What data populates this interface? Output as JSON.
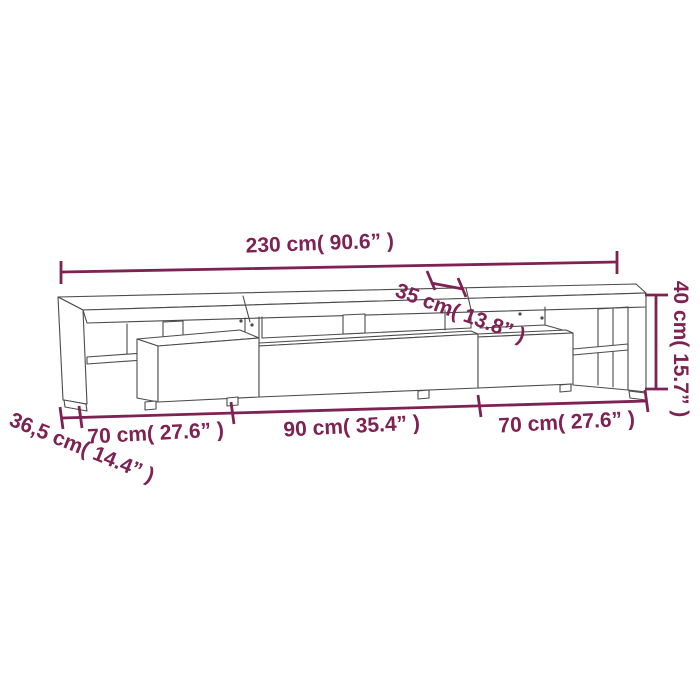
{
  "diagram": {
    "product": "tv-stand-dimension-diagram",
    "labels": {
      "total_width": "230 cm( 90.6” )",
      "top_depth": "35 cm( 13.8” )",
      "height": "40 cm( 15.7” )",
      "base_depth": "36,5 cm( 14.4” )",
      "left_section_width": "70 cm( 27.6” )",
      "middle_section_width": "90 cm( 35.4” )",
      "right_section_width": "70 cm( 27.6” )"
    },
    "colors": {
      "dimension_annotation": "#7e2153",
      "furniture_outline": "#4b4b4b",
      "background": "#ffffff"
    }
  }
}
